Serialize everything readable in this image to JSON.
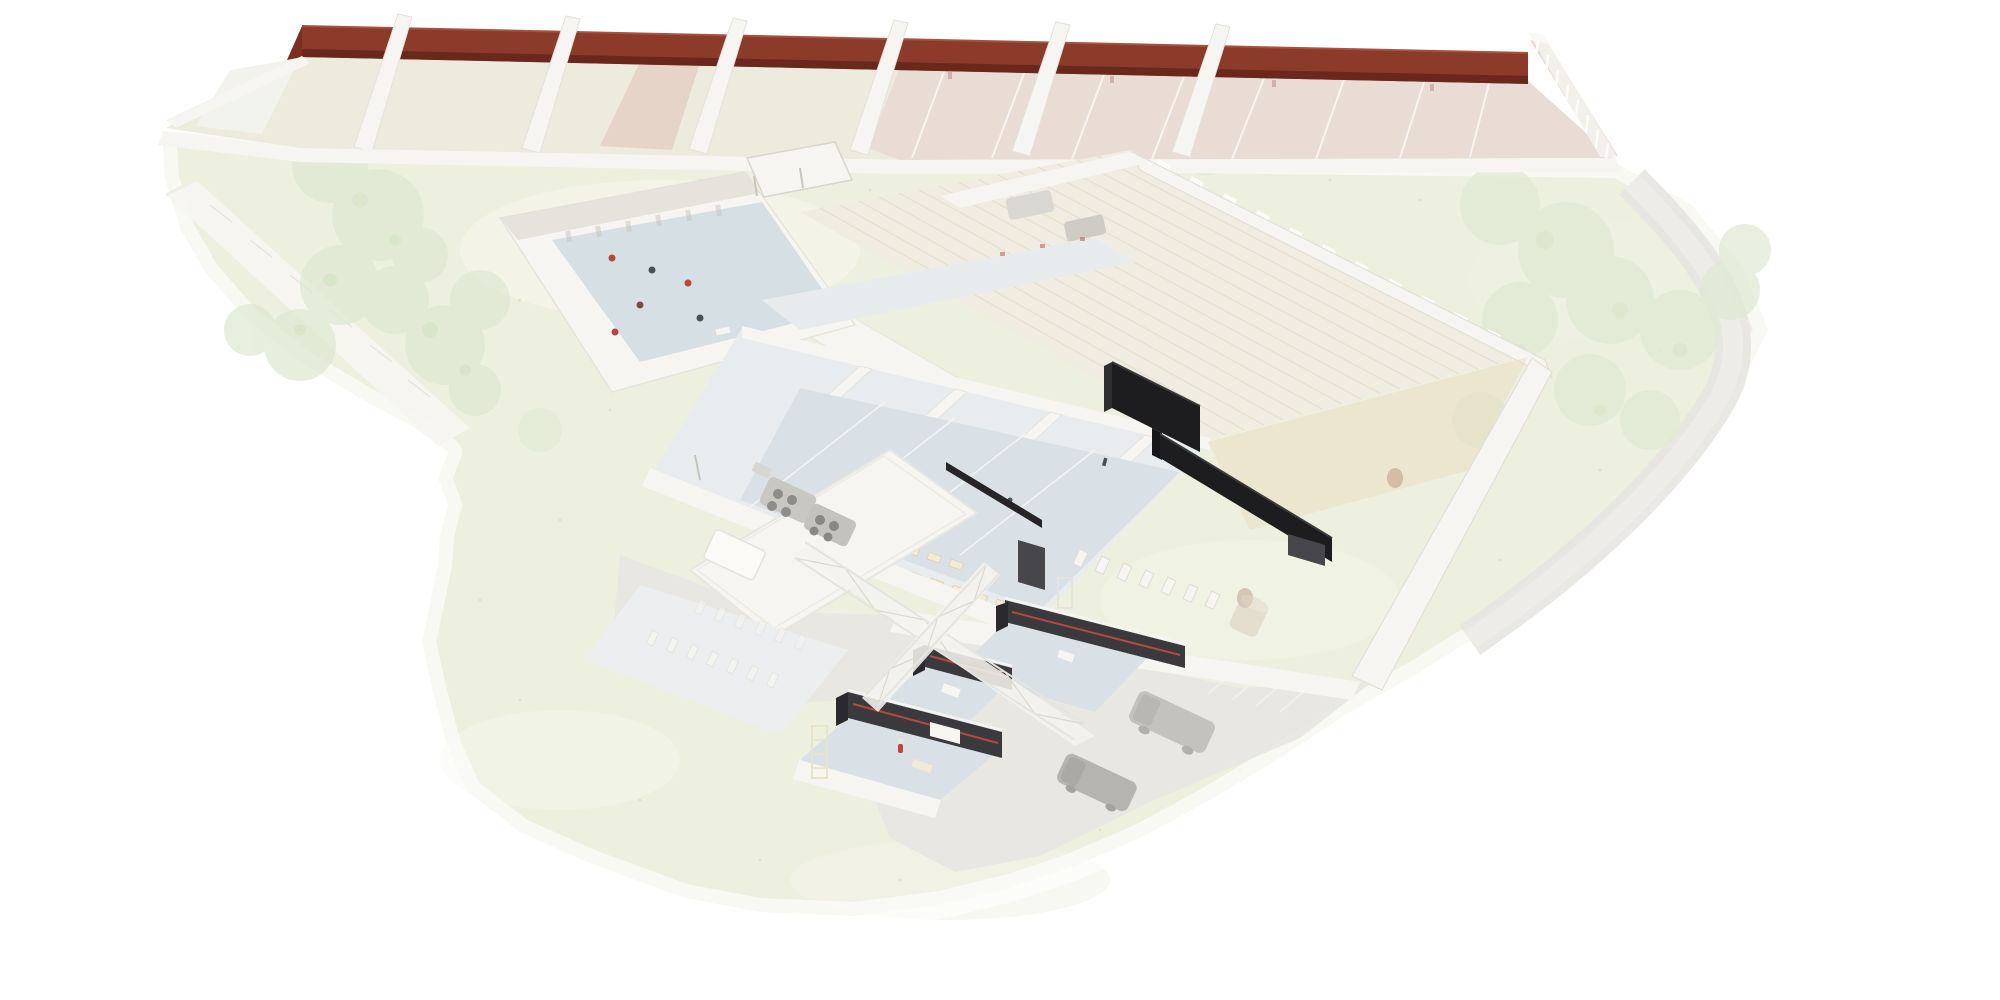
{
  "scene": {
    "type": "axonometric-architectural-site-rendering",
    "style": "ghosted white model on pale green site; selected walls rendered in saturated highlight colors",
    "highlights": [
      {
        "name": "boundary-wall-red",
        "description": "long dark red wall behind the row of sports courts",
        "color_ref": "red_wall"
      },
      {
        "name": "highlight-walls-black",
        "description": "stepped black partition walls inside the central court building",
        "color_ref": "black_wall"
      },
      {
        "name": "construction-room-walls",
        "description": "dark gray room walls with thin red stripe in the lower wing, under white scaffolding trusses",
        "color_ref": "dark_room_wall",
        "accent_ref": "red_stripe"
      }
    ],
    "counts": {
      "courts": 7,
      "court_dividers": 6,
      "construction_rooms": 3,
      "scaffold_trusses": 2,
      "vans": 2,
      "courtyard_figures": 6,
      "rooftop_fan_trays": 2
    }
  },
  "colors": {
    "site_grass": "#edf0df",
    "grass_speckle": "#ccd6ae",
    "path_gray": "#e7e6e2",
    "wall_white": "#f6f5f1",
    "wall_shadow": "#e2dfd8",
    "red_wall": "#8c3a2a",
    "red_wall_dark": "#69281b",
    "red_wall_top": "#a5523f",
    "court_pale": "#ecebdd",
    "court_pink": "#e9d9d4",
    "lane_white": "#fbfaf8",
    "roof_cream": "#f0ece1",
    "slat_line": "#e3dcca",
    "court_blue": "#d9e1e6",
    "courtyard_blue": "#d6dfe4",
    "black_wall": "#1d1d1f",
    "black_wall_top": "#3a3a3e",
    "dark_room_wall": "#3a393d",
    "dark_room_wall_deep": "#2a292d",
    "red_stripe": "#b24a3e",
    "scaffold_line": "#dbd8d1",
    "tree_green": "#dfe9d3",
    "tree_speckle": "#c9ddb9",
    "vehicle_gray": "#a19e99",
    "tan_floor": "#ead9bd",
    "bench_tan": "#f3e9d4",
    "figure_red": "#b9463c",
    "figure_dark": "#4a4e58",
    "wood_brown": "#9c6b52"
  }
}
